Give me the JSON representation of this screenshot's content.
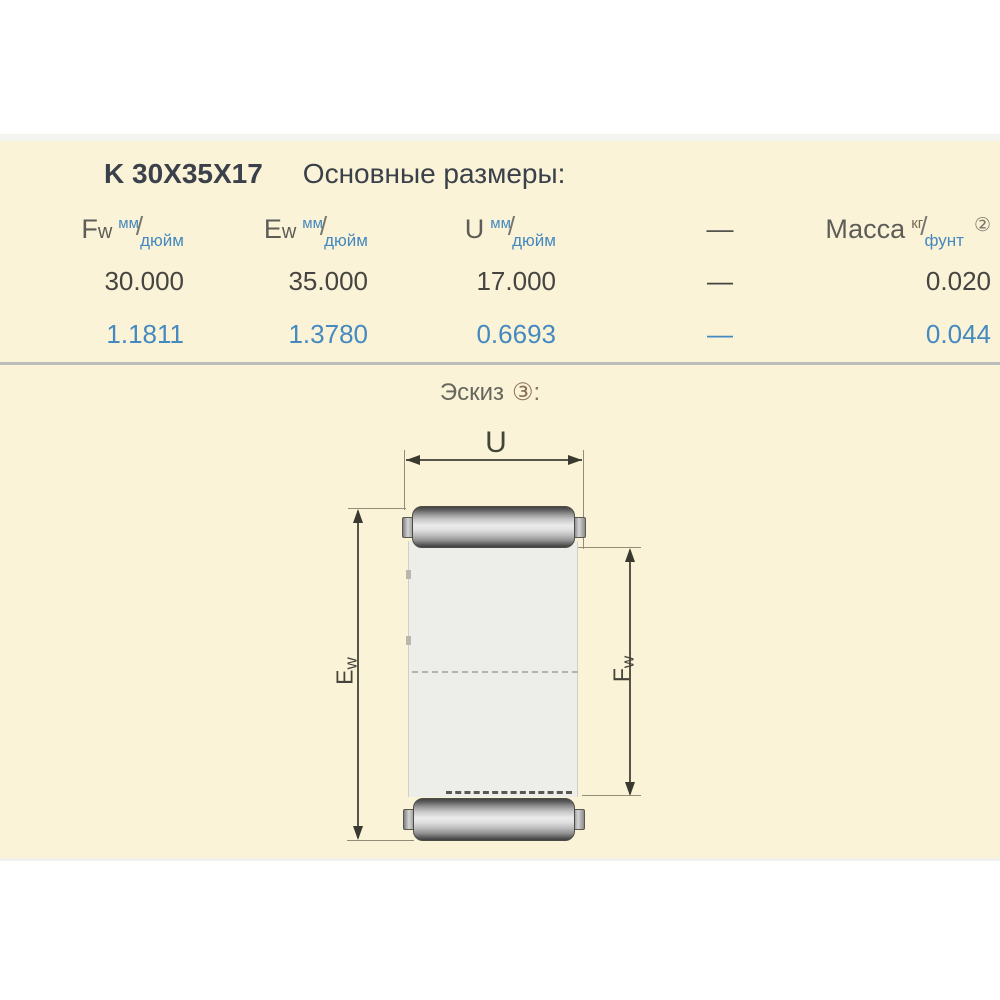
{
  "table": {
    "code": "K 30X35X17",
    "heading": "Основные размеры:",
    "headers": {
      "fw": {
        "main": "F",
        "main_sub": "w",
        "sup": "мм",
        "slash": "/",
        "sub": "дюйм"
      },
      "ew": {
        "main": "E",
        "main_sub": "w",
        "sup": "мм",
        "slash": "/",
        "sub": "дюйм"
      },
      "u": {
        "main": "U",
        "sup": "мм",
        "slash": "/",
        "sub": "дюйм"
      },
      "dash": "—",
      "mass": {
        "main": "Масса",
        "sup": "кг",
        "slash": "/",
        "sub": "фунт",
        "note": "②"
      }
    },
    "rows": {
      "mm": {
        "fw": "30.000",
        "ew": "35.000",
        "u": "17.000",
        "dash": "—",
        "mass": "0.020"
      },
      "inch": {
        "fw": "1.1811",
        "ew": "1.3780",
        "u": "0.6693",
        "dash": "—",
        "mass": "0.044"
      }
    }
  },
  "sketch": {
    "heading": "Эскиз",
    "note": "③:",
    "labels": {
      "u": "U",
      "e_main": "E",
      "e_sub": "w",
      "f_main": "F",
      "f_sub": "w"
    }
  },
  "colors": {
    "panel_cream": "#FBF3D7",
    "accent_blue": "#4489bf",
    "title_dark": "#3a414a",
    "text_gray": "#5d5c58",
    "value_dark": "#454440",
    "kg_brown": "#7a695a",
    "separator_gray": "#bdbdbc",
    "drawing_line": "#918d79",
    "drawing_dark": "#3a392f"
  }
}
